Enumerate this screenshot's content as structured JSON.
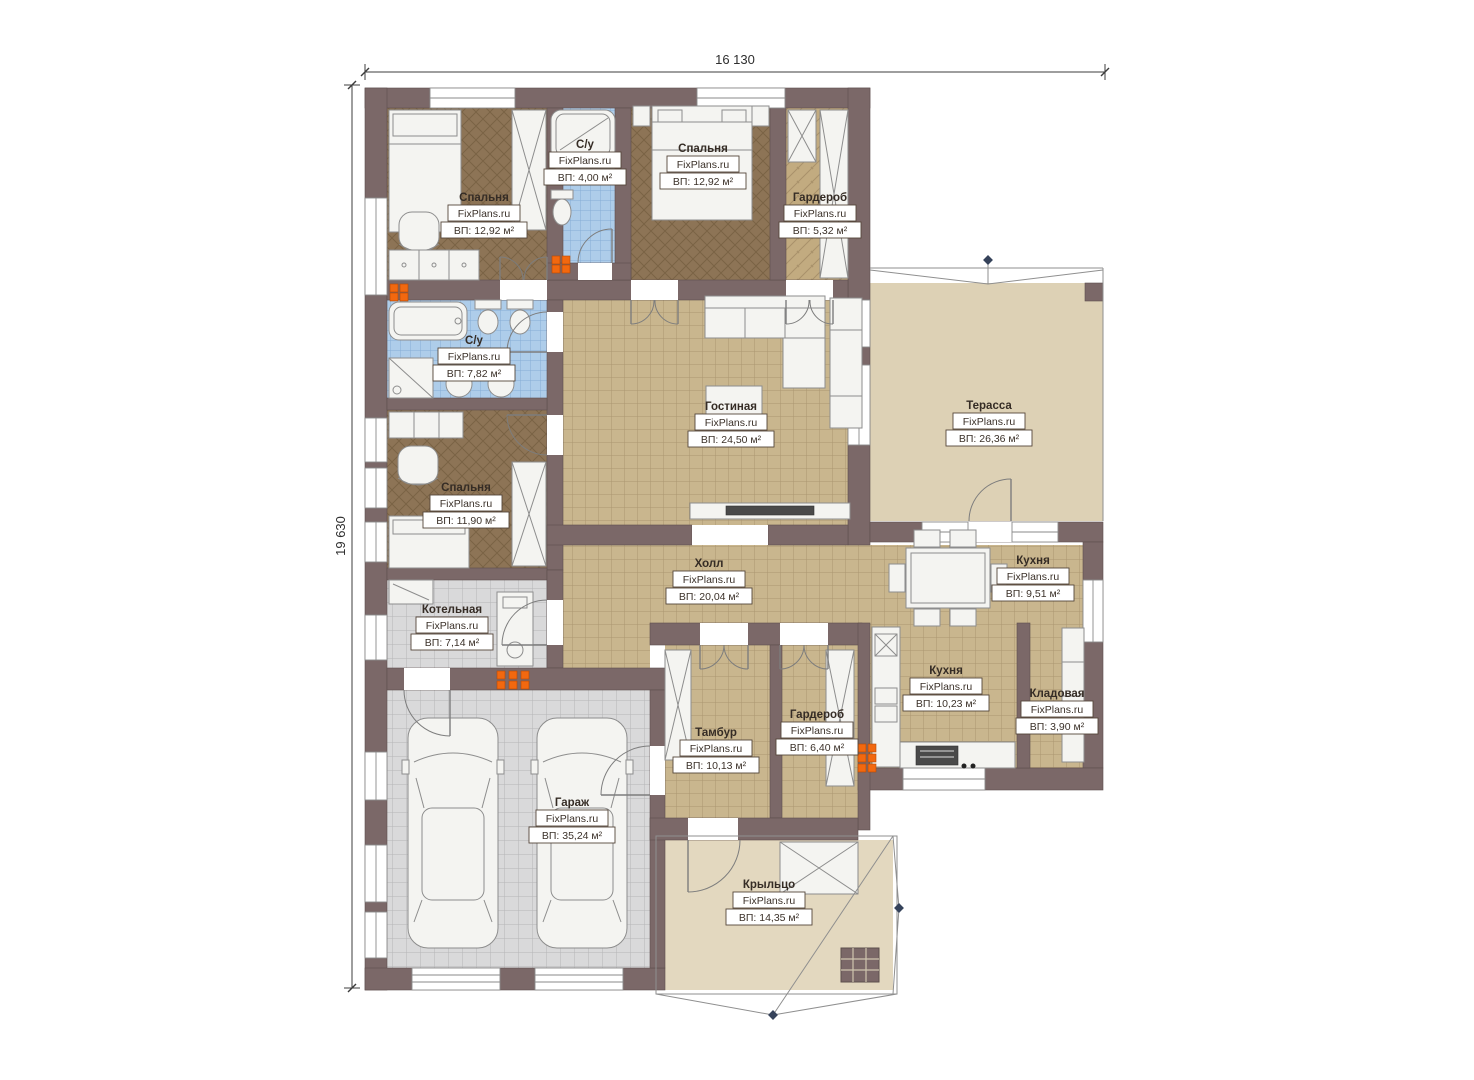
{
  "brand": "FixPlans.ru",
  "dimensions": {
    "width_mm": "16 130",
    "height_mm": "19 630"
  },
  "rooms": [
    {
      "name": "Спальня",
      "area": "ВП: 12,92 м²"
    },
    {
      "name": "С/у",
      "area": "ВП: 4,00 м²"
    },
    {
      "name": "Спальня",
      "area": "ВП: 12,92 м²"
    },
    {
      "name": "Гардероб",
      "area": "ВП: 5,32 м²"
    },
    {
      "name": "Терасса",
      "area": "ВП: 26,36 м²"
    },
    {
      "name": "С/у",
      "area": "ВП: 7,82 м²"
    },
    {
      "name": "Спальня",
      "area": "ВП: 11,90 м²"
    },
    {
      "name": "Гостиная",
      "area": "ВП: 24,50 м²"
    },
    {
      "name": "Холл",
      "area": "ВП: 20,04 м²"
    },
    {
      "name": "Кухня",
      "area": "ВП: 9,51 м²"
    },
    {
      "name": "Котельная",
      "area": "ВП: 7,14 м²"
    },
    {
      "name": "Кухня",
      "area": "ВП: 10,23 м²"
    },
    {
      "name": "Кладовая",
      "area": "ВП: 3,90 м²"
    },
    {
      "name": "Тамбур",
      "area": "ВП: 10,13 м²"
    },
    {
      "name": "Гардероб",
      "area": "ВП: 6,40 м²"
    },
    {
      "name": "Гараж",
      "area": "ВП: 35,24 м²"
    },
    {
      "name": "Крыльцо",
      "area": "ВП: 14,35 м²"
    }
  ],
  "colors": {
    "wall": "#7b6868",
    "tile_floor": "#c9b68e",
    "wood_floor": "#8d7456",
    "bath_floor": "#aecdea",
    "garage_floor": "#d9d9da",
    "terrace_floor": "#ddd1b5",
    "porch_floor": "#e3d8bf",
    "radiator": "#f2680f"
  }
}
